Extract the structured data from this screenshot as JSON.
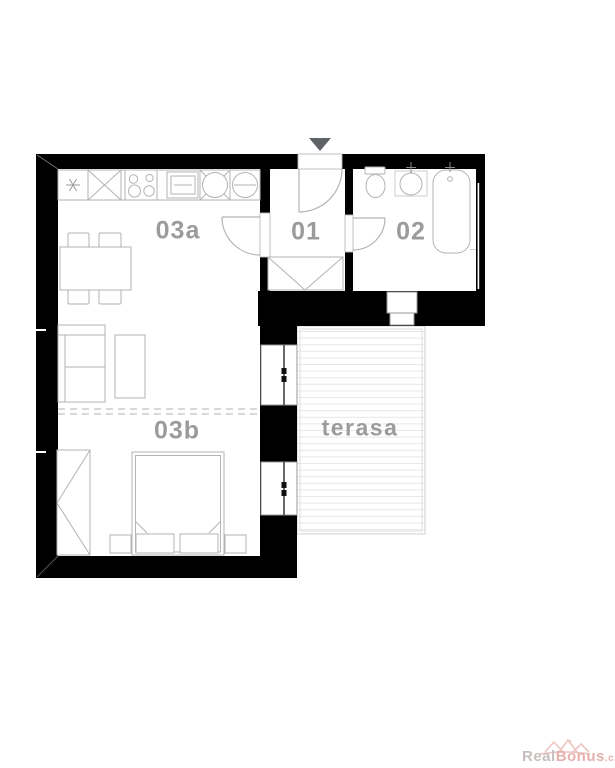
{
  "floorplan": {
    "rooms": [
      {
        "id": "living-kitchen",
        "label": "03a"
      },
      {
        "id": "hall",
        "label": "01"
      },
      {
        "id": "bathroom",
        "label": "02"
      },
      {
        "id": "bedroom",
        "label": "03b"
      },
      {
        "id": "terrace",
        "label": "terasa"
      }
    ],
    "colors": {
      "wall": "#000000",
      "furniture_line": "#b3b3b3",
      "room_label": "#9b9b9b",
      "deck_line": "#e7e7e7",
      "entrance_arrow": "#5f6368"
    }
  },
  "watermark": {
    "brand_primary": "Real",
    "brand_secondary": "Bonus",
    "brand_suffix": ".cz",
    "color_primary": "#c8bebe",
    "color_secondary": "#e6b0ad",
    "logo_color": "#edc6c3"
  }
}
